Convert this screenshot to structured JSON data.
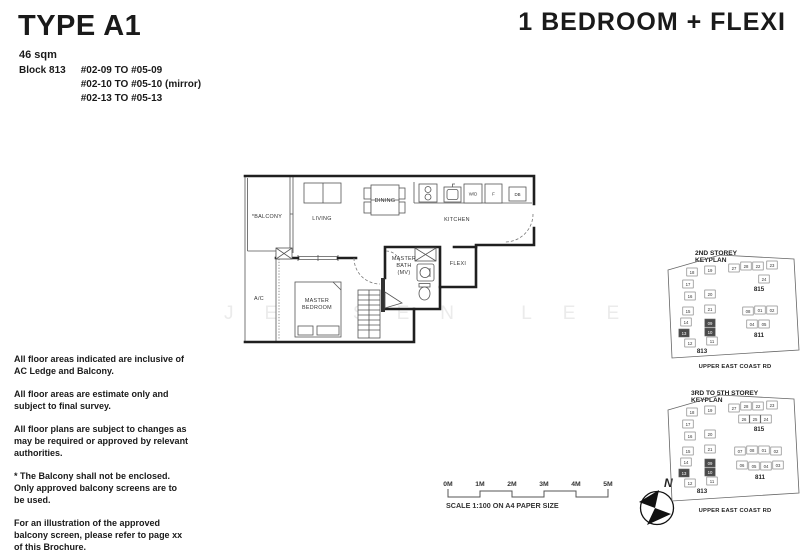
{
  "header": {
    "type_title": "TYPE A1",
    "area": "46 sqm",
    "block_label": "Block 813",
    "units": [
      "#02-09 TO #05-09",
      "#02-10 TO #05-10 (mirror)",
      "#02-13 TO #05-13"
    ],
    "category": "1 BEDROOM + FLEXI"
  },
  "floorplan": {
    "labels": {
      "balcony": "*BALCONY",
      "living": "LIVING",
      "dining": "DINING",
      "kitchen": "KITCHEN",
      "wd": "W/D",
      "f": "F",
      "db": "DB",
      "flexi": "FLEXI",
      "bath1": "MASTER",
      "bath2": "BATH",
      "bath3": "(MV)",
      "bed1": "MASTER",
      "bed2": "BEDROOM",
      "ac": "A/C"
    }
  },
  "watermark": "JENSEN LEE",
  "notes": [
    "All floor areas indicated are inclusive of AC Ledge and Balcony.",
    "All floor areas are estimate only and subject to final survey.",
    "All floor plans are subject to changes as may be required or approved by relevant authorities.",
    "* The Balcony shall not be enclosed. Only approved balcony screens are to be used.",
    "For an illustration of the approved balcony screen, please refer to page xx of this Brochure."
  ],
  "scalebar": {
    "ticks": [
      "0M",
      "1M",
      "2M",
      "3M",
      "4M",
      "5M"
    ],
    "caption": "SCALE  1:100 ON A4 PAPER SIZE"
  },
  "compass": {
    "label": "N"
  },
  "keyplans": [
    {
      "title_line1": "2ND STOREY",
      "title_line2": "KEYPLAN",
      "road": "UPPER EAST COAST RD",
      "blocks": [
        {
          "name": "813",
          "x": 40,
          "y": 105,
          "units": [
            {
              "n": "18",
              "x": 30,
              "y": 24
            },
            {
              "n": "19",
              "x": 48,
              "y": 22
            },
            {
              "n": "17",
              "x": 26,
              "y": 36
            },
            {
              "n": "16",
              "x": 28,
              "y": 48
            },
            {
              "n": "20",
              "x": 48,
              "y": 46
            },
            {
              "n": "15",
              "x": 26,
              "y": 63
            },
            {
              "n": "21",
              "x": 48,
              "y": 61
            },
            {
              "n": "14",
              "x": 24,
              "y": 74
            },
            {
              "n": "09",
              "x": 48,
              "y": 75,
              "hl": 1
            },
            {
              "n": "13",
              "x": 22,
              "y": 85,
              "hl": 1
            },
            {
              "n": "10",
              "x": 48,
              "y": 84,
              "hl": 1
            },
            {
              "n": "12",
              "x": 28,
              "y": 95
            },
            {
              "n": "11",
              "x": 50,
              "y": 93
            }
          ]
        },
        {
          "name": "815",
          "x": 97,
          "y": 43,
          "units": [
            {
              "n": "27",
              "x": 72,
              "y": 20
            },
            {
              "n": "28",
              "x": 84,
              "y": 18
            },
            {
              "n": "22",
              "x": 96,
              "y": 18
            },
            {
              "n": "23",
              "x": 110,
              "y": 17
            },
            {
              "n": "24",
              "x": 102,
              "y": 31
            }
          ]
        },
        {
          "name": "811",
          "x": 97,
          "y": 89,
          "units": [
            {
              "n": "08",
              "x": 86,
              "y": 63
            },
            {
              "n": "01",
              "x": 98,
              "y": 62
            },
            {
              "n": "02",
              "x": 110,
              "y": 62
            },
            {
              "n": "04",
              "x": 90,
              "y": 76
            },
            {
              "n": "05",
              "x": 102,
              "y": 76
            }
          ]
        }
      ]
    },
    {
      "title_line1": "3RD TO 5TH STOREY",
      "title_line2": "KEYPLAN",
      "road": "UPPER EAST COAST RD",
      "blocks": [
        {
          "name": "813",
          "x": 40,
          "y": 105,
          "units": [
            {
              "n": "18",
              "x": 30,
              "y": 24
            },
            {
              "n": "19",
              "x": 48,
              "y": 22
            },
            {
              "n": "17",
              "x": 26,
              "y": 36
            },
            {
              "n": "16",
              "x": 28,
              "y": 48
            },
            {
              "n": "20",
              "x": 48,
              "y": 46
            },
            {
              "n": "15",
              "x": 26,
              "y": 63
            },
            {
              "n": "21",
              "x": 48,
              "y": 61
            },
            {
              "n": "14",
              "x": 24,
              "y": 74
            },
            {
              "n": "09",
              "x": 48,
              "y": 75,
              "hl": 1
            },
            {
              "n": "13",
              "x": 22,
              "y": 85,
              "hl": 1
            },
            {
              "n": "10",
              "x": 48,
              "y": 84,
              "hl": 1
            },
            {
              "n": "12",
              "x": 28,
              "y": 95
            },
            {
              "n": "11",
              "x": 50,
              "y": 93
            }
          ]
        },
        {
          "name": "815",
          "x": 97,
          "y": 43,
          "units": [
            {
              "n": "27",
              "x": 72,
              "y": 20
            },
            {
              "n": "28",
              "x": 84,
              "y": 18
            },
            {
              "n": "22",
              "x": 96,
              "y": 18
            },
            {
              "n": "23",
              "x": 110,
              "y": 17
            },
            {
              "n": "26",
              "x": 82,
              "y": 31
            },
            {
              "n": "25",
              "x": 93,
              "y": 31
            },
            {
              "n": "24",
              "x": 104,
              "y": 31
            }
          ]
        },
        {
          "name": "811",
          "x": 98,
          "y": 91,
          "units": [
            {
              "n": "07",
              "x": 78,
              "y": 63
            },
            {
              "n": "08",
              "x": 90,
              "y": 62
            },
            {
              "n": "01",
              "x": 102,
              "y": 62
            },
            {
              "n": "02",
              "x": 114,
              "y": 63
            },
            {
              "n": "06",
              "x": 80,
              "y": 77
            },
            {
              "n": "05",
              "x": 92,
              "y": 78
            },
            {
              "n": "04",
              "x": 104,
              "y": 78
            },
            {
              "n": "03",
              "x": 116,
              "y": 77
            }
          ]
        }
      ]
    }
  ]
}
